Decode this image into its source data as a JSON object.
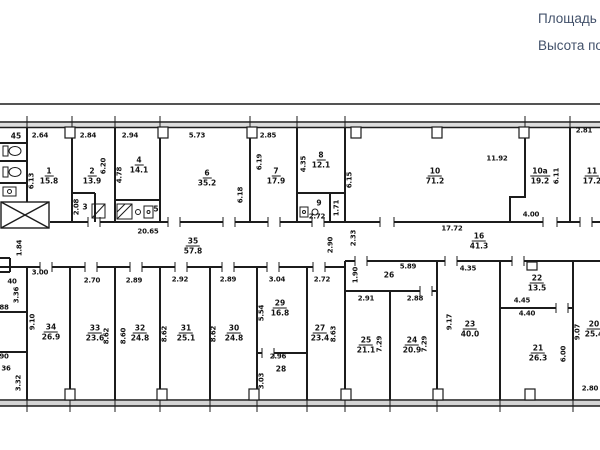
{
  "header": {
    "line1": "Площадь С",
    "line2": "Высота по"
  },
  "colors": {
    "plan_line": "#1c1c1c",
    "header_text": "#43526b",
    "wall_fill": "#dcdcdc"
  },
  "plan": {
    "rooms": [
      {
        "num": "45",
        "area": "",
        "x": 16,
        "y": 136
      },
      {
        "num": "1",
        "area": "15.8",
        "x": 49,
        "y": 176
      },
      {
        "num": "2",
        "area": "13.9",
        "x": 92,
        "y": 176
      },
      {
        "num": "3",
        "area": "",
        "x": 85,
        "y": 207
      },
      {
        "num": "4",
        "area": "14.1",
        "x": 139,
        "y": 165
      },
      {
        "num": "5",
        "area": "",
        "x": 156,
        "y": 209
      },
      {
        "num": "6",
        "area": "35.2",
        "x": 207,
        "y": 178
      },
      {
        "num": "7",
        "area": "17.9",
        "x": 276,
        "y": 176
      },
      {
        "num": "8",
        "area": "12.1",
        "x": 321,
        "y": 160
      },
      {
        "num": "9",
        "area": "",
        "x": 319,
        "y": 203
      },
      {
        "num": "10",
        "area": "71.2",
        "x": 435,
        "y": 176
      },
      {
        "num": "10а",
        "area": "19.2",
        "x": 540,
        "y": 176
      },
      {
        "num": "11",
        "area": "17.2",
        "x": 592,
        "y": 176
      },
      {
        "num": "35",
        "area": "57.8",
        "x": 193,
        "y": 246
      },
      {
        "num": "16",
        "area": "41.3",
        "x": 479,
        "y": 241
      },
      {
        "num": "26",
        "area": "",
        "x": 389,
        "y": 275
      },
      {
        "num": "34",
        "area": "26.9",
        "x": 51,
        "y": 332
      },
      {
        "num": "33",
        "area": "23.6",
        "x": 95,
        "y": 333
      },
      {
        "num": "32",
        "area": "24.8",
        "x": 140,
        "y": 333
      },
      {
        "num": "31",
        "area": "25.1",
        "x": 186,
        "y": 333
      },
      {
        "num": "30",
        "area": "24.8",
        "x": 234,
        "y": 333
      },
      {
        "num": "29",
        "area": "16.8",
        "x": 280,
        "y": 308
      },
      {
        "num": "28",
        "area": "",
        "x": 281,
        "y": 369
      },
      {
        "num": "27",
        "area": "23.4",
        "x": 320,
        "y": 333
      },
      {
        "num": "25",
        "area": "21.1",
        "x": 366,
        "y": 345
      },
      {
        "num": "24",
        "area": "20.9",
        "x": 412,
        "y": 345
      },
      {
        "num": "23",
        "area": "40.0",
        "x": 470,
        "y": 329
      },
      {
        "num": "22",
        "area": "13.5",
        "x": 537,
        "y": 283
      },
      {
        "num": "21",
        "area": "26.3",
        "x": 538,
        "y": 353
      },
      {
        "num": "20",
        "area": "25.4",
        "x": 594,
        "y": 329
      }
    ],
    "dims": [
      {
        "t": "2.64",
        "x": 40,
        "y": 136
      },
      {
        "t": "2.84",
        "x": 88,
        "y": 136
      },
      {
        "t": "2.94",
        "x": 130,
        "y": 136
      },
      {
        "t": "5.73",
        "x": 197,
        "y": 136
      },
      {
        "t": "2.85",
        "x": 268,
        "y": 136
      },
      {
        "t": "2.81",
        "x": 584,
        "y": 131
      },
      {
        "t": "6.13",
        "x": 32,
        "y": 181,
        "v": true
      },
      {
        "t": "6.20",
        "x": 104,
        "y": 166,
        "v": true
      },
      {
        "t": "2.08",
        "x": 77,
        "y": 207,
        "v": true
      },
      {
        "t": "4.78",
        "x": 120,
        "y": 175,
        "v": true
      },
      {
        "t": "6.19",
        "x": 260,
        "y": 162,
        "v": true
      },
      {
        "t": "6.18",
        "x": 241,
        "y": 195,
        "v": true
      },
      {
        "t": "4.35",
        "x": 304,
        "y": 164,
        "v": true
      },
      {
        "t": "1.71",
        "x": 337,
        "y": 208,
        "v": true
      },
      {
        "t": "2.72",
        "x": 317,
        "y": 217
      },
      {
        "t": "6.15",
        "x": 350,
        "y": 180,
        "v": true
      },
      {
        "t": "11.92",
        "x": 497,
        "y": 159
      },
      {
        "t": "4.00",
        "x": 531,
        "y": 215
      },
      {
        "t": "6.11",
        "x": 557,
        "y": 176,
        "v": true
      },
      {
        "t": "17.72",
        "x": 452,
        "y": 229
      },
      {
        "t": "20.65",
        "x": 148,
        "y": 232
      },
      {
        "t": "2.33",
        "x": 354,
        "y": 238,
        "v": true
      },
      {
        "t": "2.90",
        "x": 331,
        "y": 245,
        "v": true
      },
      {
        "t": "1.84",
        "x": 20,
        "y": 248,
        "v": true
      },
      {
        "t": "3.00",
        "x": 40,
        "y": 273
      },
      {
        "t": "2.70",
        "x": 92,
        "y": 281
      },
      {
        "t": "2.89",
        "x": 134,
        "y": 281
      },
      {
        "t": "2.92",
        "x": 180,
        "y": 280
      },
      {
        "t": "2.89",
        "x": 228,
        "y": 280
      },
      {
        "t": "3.04",
        "x": 277,
        "y": 280
      },
      {
        "t": "2.72",
        "x": 322,
        "y": 280
      },
      {
        "t": "5.89",
        "x": 408,
        "y": 267
      },
      {
        "t": "4.35",
        "x": 468,
        "y": 269
      },
      {
        "t": "1.90",
        "x": 356,
        "y": 275,
        "v": true
      },
      {
        "t": "2.91",
        "x": 366,
        "y": 299
      },
      {
        "t": "2.88",
        "x": 415,
        "y": 299
      },
      {
        "t": "9.10",
        "x": 33,
        "y": 322,
        "v": true
      },
      {
        "t": "3.36",
        "x": 17,
        "y": 295,
        "v": true
      },
      {
        "t": "40",
        "x": 12,
        "y": 282
      },
      {
        "t": "88",
        "x": 4,
        "y": 308
      },
      {
        "t": "90",
        "x": 4,
        "y": 357
      },
      {
        "t": "36",
        "x": 6,
        "y": 369
      },
      {
        "t": "3.32",
        "x": 19,
        "y": 383,
        "v": true
      },
      {
        "t": "8.62",
        "x": 107,
        "y": 336,
        "v": true
      },
      {
        "t": "8.60",
        "x": 124,
        "y": 336,
        "v": true
      },
      {
        "t": "8.62",
        "x": 165,
        "y": 334,
        "v": true
      },
      {
        "t": "8.62",
        "x": 214,
        "y": 334,
        "v": true
      },
      {
        "t": "5.54",
        "x": 262,
        "y": 313,
        "v": true
      },
      {
        "t": "2.96",
        "x": 278,
        "y": 357
      },
      {
        "t": "3.03",
        "x": 262,
        "y": 381,
        "v": true
      },
      {
        "t": "8.63",
        "x": 334,
        "y": 334,
        "v": true
      },
      {
        "t": "7.29",
        "x": 380,
        "y": 344,
        "v": true
      },
      {
        "t": "7.29",
        "x": 425,
        "y": 344,
        "v": true
      },
      {
        "t": "9.17",
        "x": 450,
        "y": 322,
        "v": true
      },
      {
        "t": "4.45",
        "x": 522,
        "y": 301
      },
      {
        "t": "4.40",
        "x": 527,
        "y": 314
      },
      {
        "t": "9.07",
        "x": 578,
        "y": 332,
        "v": true
      },
      {
        "t": "6.00",
        "x": 564,
        "y": 354,
        "v": true
      },
      {
        "t": "2.80",
        "x": 590,
        "y": 389
      }
    ]
  }
}
